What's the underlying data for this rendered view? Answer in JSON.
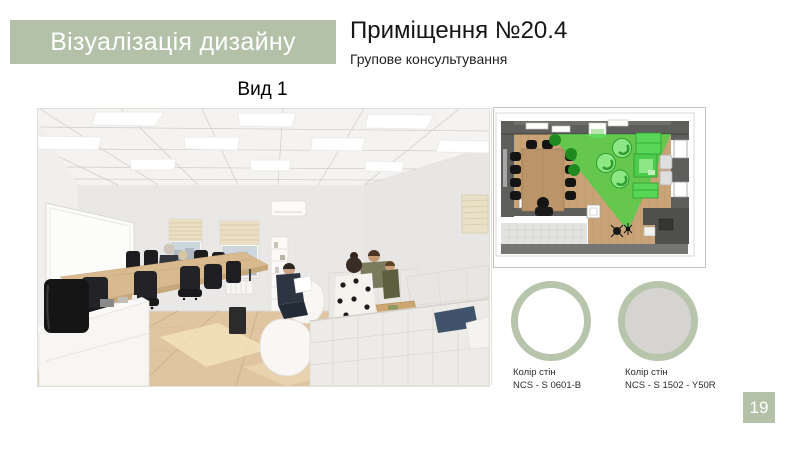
{
  "banner": {
    "title": "Візуалізація дизайну"
  },
  "header": {
    "title": "Приміщення №20.4",
    "subtitle": "Групове консультування"
  },
  "view": {
    "label": "Вид 1"
  },
  "swatches": [
    {
      "label": "Колір стін",
      "code": "NCS - S 0601-B",
      "fill": "#ffffff"
    },
    {
      "label": "Колір стін",
      "code": "NCS - S 1502 - Y50R",
      "fill": "#d6d4d1"
    }
  ],
  "page": {
    "number": "19"
  },
  "colors": {
    "accent": "#b2c1a7",
    "swatch_ring": "#b7c5ad",
    "view_cone_green": "#3ed43e"
  }
}
